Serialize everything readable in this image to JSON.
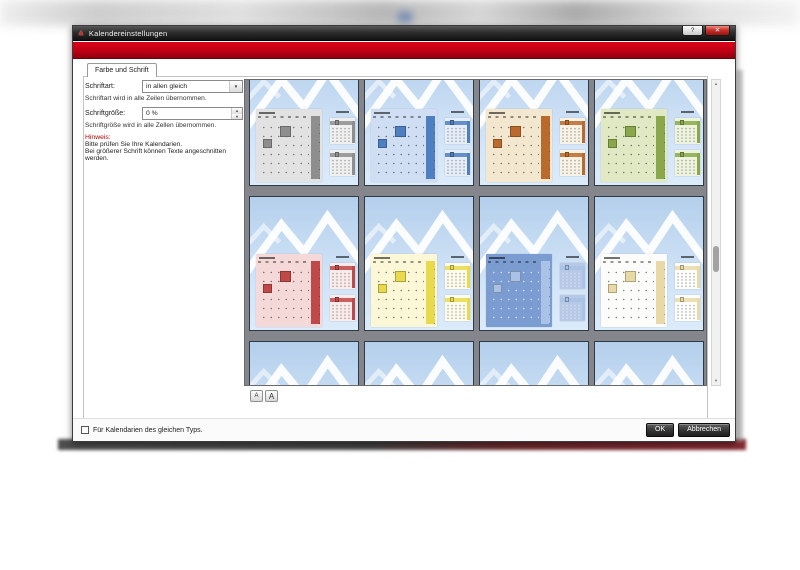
{
  "window": {
    "title": "Kalendereinstellungen"
  },
  "icons": {
    "logo": "▲",
    "help": "?",
    "close": "✕",
    "dropdown": "▼",
    "spin_up": "▲",
    "spin_down": "▼",
    "scroll_up": "▲",
    "scroll_down": "▼"
  },
  "tab": {
    "label": "Farbe und Schrift"
  },
  "form": {
    "font_label": "Schriftart:",
    "font_value": "in allen gleich",
    "font_caption": "Schriftart wird in alle Zeilen übernommen.",
    "size_label": "Schriftgröße:",
    "size_value": "0 %",
    "size_caption": "Schriftgröße wird in alle Zellen übernommen.",
    "note_title": "Hinweis:",
    "note_line1": "Bitte prüfen Sie Ihre Kalendarien.",
    "note_line2": "Bei größerer Schrift können Texte angeschnitten werden."
  },
  "preview": {
    "font_small_label": "A",
    "font_large_label": "A",
    "schemes": [
      {
        "name": "gray",
        "panel": "#e2e2e2",
        "accent": "#8e8e8e",
        "light_text": false
      },
      {
        "name": "blue",
        "panel": "#cfdef2",
        "accent": "#4f7fbe",
        "light_text": false
      },
      {
        "name": "orange",
        "panel": "#f3e7cf",
        "accent": "#ba6a2d",
        "light_text": false
      },
      {
        "name": "green",
        "panel": "#e0e9c4",
        "accent": "#8aa84b",
        "light_text": false
      },
      {
        "name": "red",
        "panel": "#f5d8d8",
        "accent": "#bf4848",
        "light_text": false
      },
      {
        "name": "yellow",
        "panel": "#fcf8d7",
        "accent": "#e9d94e",
        "light_text": false
      },
      {
        "name": "dark-blue",
        "panel": "#7b9cd0",
        "accent": "#a9c2e6",
        "light_text": true
      },
      {
        "name": "white",
        "panel": "#fcfcfa",
        "accent": "#e9d9a6",
        "light_text": false
      },
      {
        "name": "cropped-1",
        "panel": "#e2e2e2",
        "accent": "#8e8e8e",
        "light_text": false
      },
      {
        "name": "cropped-2",
        "panel": "#cfdef2",
        "accent": "#4f7fbe",
        "light_text": false
      },
      {
        "name": "cropped-3",
        "panel": "#f3e7cf",
        "accent": "#ba6a2d",
        "light_text": false
      },
      {
        "name": "cropped-4",
        "panel": "#e0e9c4",
        "accent": "#8aa84b",
        "light_text": false
      }
    ]
  },
  "footer": {
    "checkbox_label": "Für Kalendarien des gleichen Typs.",
    "checkbox_checked": false,
    "ok_label": "OK",
    "cancel_label": "Abbrechen"
  },
  "colors": {
    "banner": "#c00014",
    "titlebar": "#2e2e2e",
    "grid_bg": "#85868c"
  }
}
